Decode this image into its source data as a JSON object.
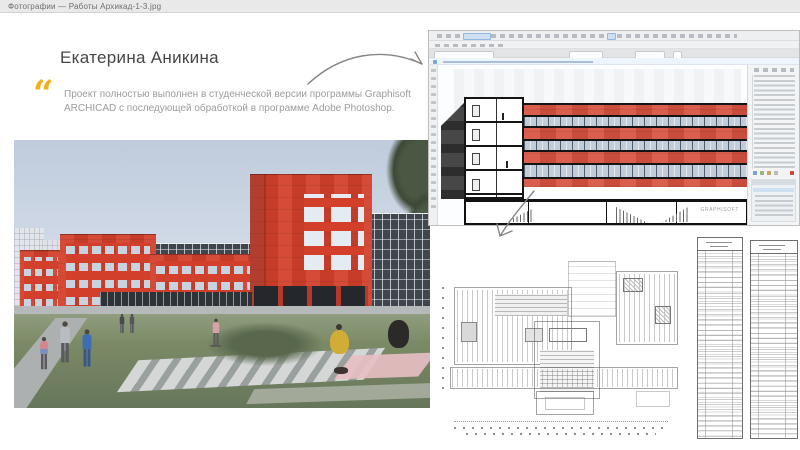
{
  "window": {
    "title": "Фотографии — Работы Архикад-1-3.jpg"
  },
  "slide": {
    "author": "Екатерина Аникина",
    "quote_mark": "“",
    "quote_text": "Проект полностью выполнен в студенческой версии программы Graphisoft ARCHICAD с последующей обработкой в программе Adobe Photoshop.",
    "colors": {
      "quote_accent": "#F2B01E",
      "building_red": "#D2402C",
      "sky_blue": "#BFCBDC",
      "grass_green": "#7B8A66"
    }
  },
  "archicad": {
    "watermark": "GRAPHISOFT"
  }
}
